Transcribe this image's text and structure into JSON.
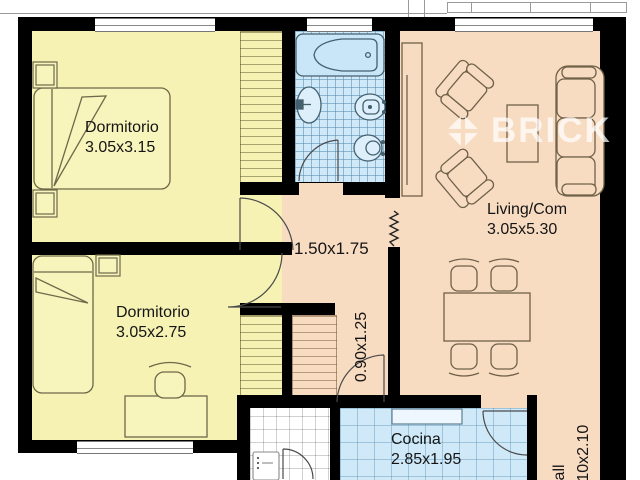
{
  "plan": {
    "watermark": "BRICK",
    "rooms": [
      {
        "label": "Dormitorio",
        "dims": "3.05x3.15"
      },
      {
        "label": "Dormitorio",
        "dims": "3.05x2.75"
      },
      {
        "label": "Living/Com",
        "dims": "3.05x5.30"
      },
      {
        "label": "Cocina",
        "dims": "2.85x1.95"
      },
      {
        "dims": "1.50x1.75"
      },
      {
        "dims": "0.90x1.25"
      },
      {
        "label": "Hall",
        "dims": "1.10x2.10"
      }
    ],
    "colors": {
      "bedroom": "#f5f2b4",
      "living": "#f8dcc2",
      "tile_blue": "#cfe9f8",
      "laundry": "#ffffff",
      "wall": "#000000"
    }
  }
}
